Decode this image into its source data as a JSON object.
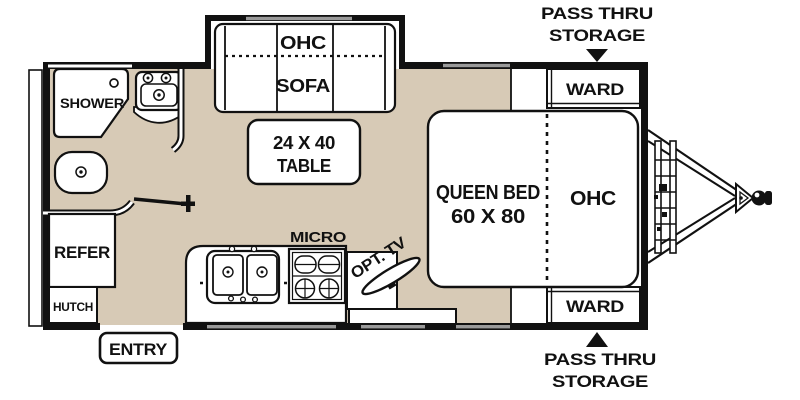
{
  "diagram_type": "travel-trailer-floorplan",
  "labels": {
    "shower": "SHOWER",
    "sofa": "SOFA",
    "sofa_ohc": "OHC",
    "table_size": "24 X 40",
    "table": "TABLE",
    "micro": "MICRO",
    "opt_tv": "OPT. TV",
    "queen_bed": "QUEEN BED",
    "queen_bed_size": "60 X 80",
    "bed_ohc": "OHC",
    "ward": "WARD",
    "refer": "REFER",
    "hutch": "HUTCH",
    "entry": "ENTRY",
    "pass_thru_line1": "PASS THRU",
    "pass_thru_line2": "STORAGE"
  },
  "colors": {
    "floor": "#d7cab6",
    "wall": "#111111",
    "fixture_fill": "#ffffff",
    "window_band": "#9a9a9a",
    "text": "#111111"
  }
}
